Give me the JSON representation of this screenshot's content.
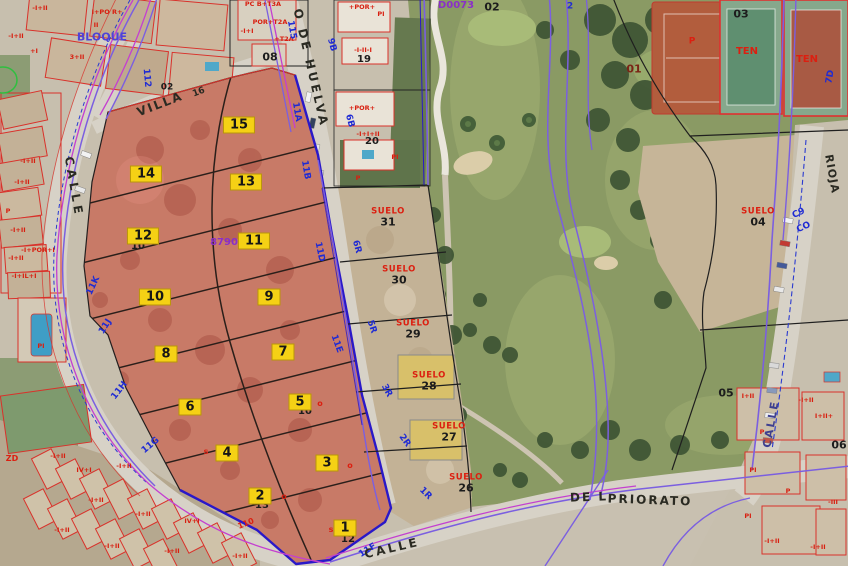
{
  "map": {
    "kind": "cadastral-parcel-viewer-orthophoto",
    "colors": {
      "selection_fill": "#c44b3e",
      "marker_bg": "#f5d115",
      "cadastral_red": "#d9312a",
      "boundary_blue": "#2a18c8",
      "contour_purple": "#7b5fe0",
      "magenta_line": "#c43fd0",
      "suelo_red": "#dc1f10",
      "blue_code": "#1f2bd4"
    }
  },
  "labels": {
    "parcel_markers": [
      {
        "n": "15",
        "x": 239,
        "y": 125
      },
      {
        "n": "14",
        "x": 146,
        "y": 174
      },
      {
        "n": "13",
        "x": 246,
        "y": 182
      },
      {
        "n": "12",
        "x": 143,
        "y": 236
      },
      {
        "n": "11",
        "x": 254,
        "y": 241
      },
      {
        "n": "10",
        "x": 155,
        "y": 297
      },
      {
        "n": "9",
        "x": 269,
        "y": 297
      },
      {
        "n": "8",
        "x": 166,
        "y": 354
      },
      {
        "n": "7",
        "x": 283,
        "y": 352
      },
      {
        "n": "6",
        "x": 190,
        "y": 407
      },
      {
        "n": "5",
        "x": 300,
        "y": 402
      },
      {
        "n": "4",
        "x": 227,
        "y": 453
      },
      {
        "n": "3",
        "x": 327,
        "y": 463
      },
      {
        "n": "2",
        "x": 260,
        "y": 496
      },
      {
        "n": "1",
        "x": 345,
        "y": 528
      }
    ],
    "suelo_parcels": [
      {
        "t": "SUELO",
        "n": "31",
        "x": 388,
        "y": 217
      },
      {
        "t": "SUELO",
        "n": "30",
        "x": 399,
        "y": 275
      },
      {
        "t": "SUELO",
        "n": "29",
        "x": 413,
        "y": 329
      },
      {
        "t": "SUELO",
        "n": "28",
        "x": 429,
        "y": 381
      },
      {
        "t": "SUELO",
        "n": "27",
        "x": 449,
        "y": 432
      },
      {
        "t": "SUELO",
        "n": "26",
        "x": 466,
        "y": 483
      },
      {
        "t": "SUELO",
        "n": "04",
        "x": 758,
        "y": 217
      }
    ],
    "black_codes": [
      {
        "t": "02",
        "x": 492,
        "y": 7
      },
      {
        "t": "03",
        "x": 741,
        "y": 14
      },
      {
        "t": "08",
        "x": 270,
        "y": 57
      },
      {
        "t": "02",
        "x": 167,
        "y": 88,
        "fs": 9
      },
      {
        "t": "19",
        "x": 364,
        "y": 60,
        "fs": 10
      },
      {
        "t": "20",
        "x": 372,
        "y": 142,
        "fs": 10
      },
      {
        "t": "05",
        "x": 726,
        "y": 393
      },
      {
        "t": "06",
        "x": 839,
        "y": 445
      },
      {
        "t": "01",
        "x": 634,
        "y": 69,
        "c": "#7a2415"
      }
    ],
    "blue_codes": [
      {
        "t": "115",
        "x": 291,
        "y": 30,
        "rot": 80
      },
      {
        "t": "11A",
        "x": 296,
        "y": 112,
        "rot": 80
      },
      {
        "t": "9B",
        "x": 331,
        "y": 45,
        "rot": 75
      },
      {
        "t": "6B",
        "x": 349,
        "y": 121,
        "rot": 75
      },
      {
        "t": "112",
        "x": 146,
        "y": 78,
        "rot": 85
      },
      {
        "t": "6R",
        "x": 356,
        "y": 247,
        "rot": 75
      },
      {
        "t": "5R",
        "x": 371,
        "y": 327,
        "rot": 72
      },
      {
        "t": "3R",
        "x": 386,
        "y": 391,
        "rot": 62
      },
      {
        "t": "2R",
        "x": 404,
        "y": 441,
        "rot": 55
      },
      {
        "t": "1R",
        "x": 425,
        "y": 494,
        "rot": 45
      },
      {
        "t": "11B",
        "x": 305,
        "y": 170,
        "rot": 80
      },
      {
        "t": "11D",
        "x": 319,
        "y": 252,
        "rot": 78
      },
      {
        "t": "11E",
        "x": 336,
        "y": 344,
        "rot": 70
      },
      {
        "t": "11K",
        "x": 94,
        "y": 286,
        "rot": -65
      },
      {
        "t": "11J",
        "x": 106,
        "y": 327,
        "rot": -58
      },
      {
        "t": "11H",
        "x": 120,
        "y": 391,
        "rot": -52
      },
      {
        "t": "11G",
        "x": 151,
        "y": 446,
        "rot": -40
      },
      {
        "t": "11F",
        "x": 368,
        "y": 551,
        "rot": -32
      },
      {
        "t": "2",
        "x": 570,
        "y": 7
      },
      {
        "t": "7D",
        "x": 831,
        "y": 77,
        "rot": -80
      },
      {
        "t": "C9",
        "x": 799,
        "y": 214,
        "rot": -25
      },
      {
        "t": "CO",
        "x": 804,
        "y": 228,
        "rot": -25
      }
    ],
    "red_texts": [
      {
        "t": "TEN",
        "x": 747,
        "y": 52,
        "fs": 10
      },
      {
        "t": "TEN",
        "x": 807,
        "y": 60,
        "fs": 10
      },
      {
        "t": "P",
        "x": 692,
        "y": 42
      },
      {
        "t": "ZD",
        "x": 12,
        "y": 459,
        "fs": 8
      },
      {
        "t": "110",
        "x": 246,
        "y": 524,
        "fs": 8,
        "rot": -22
      }
    ],
    "street_names": [
      {
        "t": "CALLE",
        "x": 74,
        "y": 187,
        "rot": 80,
        "ls": 4
      },
      {
        "t": "O  DE  HUELVA",
        "x": 311,
        "y": 68,
        "rot": 77,
        "ls": 3
      },
      {
        "t": "VILLA",
        "x": 160,
        "y": 104,
        "rot": -21,
        "ls": 2
      },
      {
        "t": "16",
        "x": 199,
        "y": 93,
        "rot": -21,
        "fs": 9
      },
      {
        "t": "CALLE",
        "x": 392,
        "y": 548,
        "rot": -13,
        "ls": 3
      },
      {
        "t": "DE L",
        "x": 589,
        "y": 497,
        "rot": -2,
        "ls": 2
      },
      {
        "t": "PRIORATO",
        "x": 650,
        "y": 500,
        "rot": 2,
        "ls": 2
      },
      {
        "t": "RIOJA",
        "x": 832,
        "y": 174,
        "rot": 80,
        "ls": 1,
        "fs": 11
      },
      {
        "t": "CALLE",
        "x": 771,
        "y": 424,
        "rot": -80,
        "ls": 2,
        "fs": 11,
        "c": "#3d3f90"
      }
    ],
    "purple_texts": [
      {
        "t": "D0073",
        "x": 456,
        "y": 6,
        "c": "#8a2fc8"
      },
      {
        "t": "BLOQUE",
        "x": 102,
        "y": 37,
        "fs": 11,
        "c": "#4f43d8"
      },
      {
        "t": "8790",
        "x": 224,
        "y": 243,
        "c": "#8a2fc8"
      }
    ],
    "building_labels": [
      {
        "t": "-I+II",
        "x": 40,
        "y": 8
      },
      {
        "t": "I+PO R+",
        "x": 107,
        "y": 12
      },
      {
        "t": "II",
        "x": 96,
        "y": 25
      },
      {
        "t": "-I+II",
        "x": 16,
        "y": 36
      },
      {
        "t": "+I",
        "x": 34,
        "y": 51
      },
      {
        "t": "3+II",
        "x": 77,
        "y": 57
      },
      {
        "t": "-I+II",
        "x": 28,
        "y": 161
      },
      {
        "t": "-I+II",
        "x": 22,
        "y": 182
      },
      {
        "t": "P",
        "x": 8,
        "y": 211
      },
      {
        "t": "-I+II",
        "x": 18,
        "y": 230
      },
      {
        "t": "-I+POR+I",
        "x": 38,
        "y": 250
      },
      {
        "t": "-I+II",
        "x": 16,
        "y": 258
      },
      {
        "t": "-I+IL+I",
        "x": 24,
        "y": 276
      },
      {
        "t": "PI",
        "x": 41,
        "y": 346
      },
      {
        "t": "PC B+T3A",
        "x": 263,
        "y": 4
      },
      {
        "t": "POR+T2A",
        "x": 270,
        "y": 22
      },
      {
        "t": "-I+I",
        "x": 247,
        "y": 31
      },
      {
        "t": "+T2A",
        "x": 284,
        "y": 39
      },
      {
        "t": "+POR+",
        "x": 362,
        "y": 7
      },
      {
        "t": "PI",
        "x": 381,
        "y": 14
      },
      {
        "t": "-I-II-I",
        "x": 363,
        "y": 50
      },
      {
        "t": "+POR+",
        "x": 362,
        "y": 108
      },
      {
        "t": "-I+I+II",
        "x": 368,
        "y": 134
      },
      {
        "t": "PI",
        "x": 395,
        "y": 157
      },
      {
        "t": "P",
        "x": 358,
        "y": 178
      },
      {
        "t": "-I+II",
        "x": 58,
        "y": 456
      },
      {
        "t": "IV+I",
        "x": 84,
        "y": 470
      },
      {
        "t": "-I+II",
        "x": 124,
        "y": 466
      },
      {
        "t": "-I+II",
        "x": 96,
        "y": 500
      },
      {
        "t": "-I+II",
        "x": 143,
        "y": 514
      },
      {
        "t": "IV+I",
        "x": 192,
        "y": 521
      },
      {
        "t": "-I+II",
        "x": 62,
        "y": 530
      },
      {
        "t": "-I+II",
        "x": 112,
        "y": 546
      },
      {
        "t": "-I+II",
        "x": 172,
        "y": 551
      },
      {
        "t": "-I+II",
        "x": 240,
        "y": 556
      },
      {
        "t": "I+II",
        "x": 748,
        "y": 396
      },
      {
        "t": "P",
        "x": 762,
        "y": 432
      },
      {
        "t": "PI",
        "x": 753,
        "y": 470
      },
      {
        "t": "-I+II",
        "x": 806,
        "y": 400
      },
      {
        "t": "I+II+",
        "x": 824,
        "y": 416
      },
      {
        "t": "P",
        "x": 788,
        "y": 491
      },
      {
        "t": "-III",
        "x": 833,
        "y": 502
      },
      {
        "t": "-I+II",
        "x": 772,
        "y": 541
      },
      {
        "t": "PI",
        "x": 748,
        "y": 516
      },
      {
        "t": "-I+II",
        "x": 818,
        "y": 547
      }
    ],
    "peek_texts": [
      {
        "t": "s",
        "x": 331,
        "y": 530,
        "r": 1
      },
      {
        "t": "12",
        "x": 348,
        "y": 540
      },
      {
        "t": "13",
        "x": 262,
        "y": 506
      },
      {
        "t": "o",
        "x": 284,
        "y": 497,
        "r": 1
      },
      {
        "t": "o",
        "x": 350,
        "y": 466,
        "r": 1
      },
      {
        "t": "s",
        "x": 206,
        "y": 452,
        "r": 1
      },
      {
        "t": "10",
        "x": 305,
        "y": 412
      },
      {
        "t": "o",
        "x": 320,
        "y": 404,
        "r": 1
      },
      {
        "t": "10",
        "x": 138,
        "y": 247
      }
    ]
  }
}
